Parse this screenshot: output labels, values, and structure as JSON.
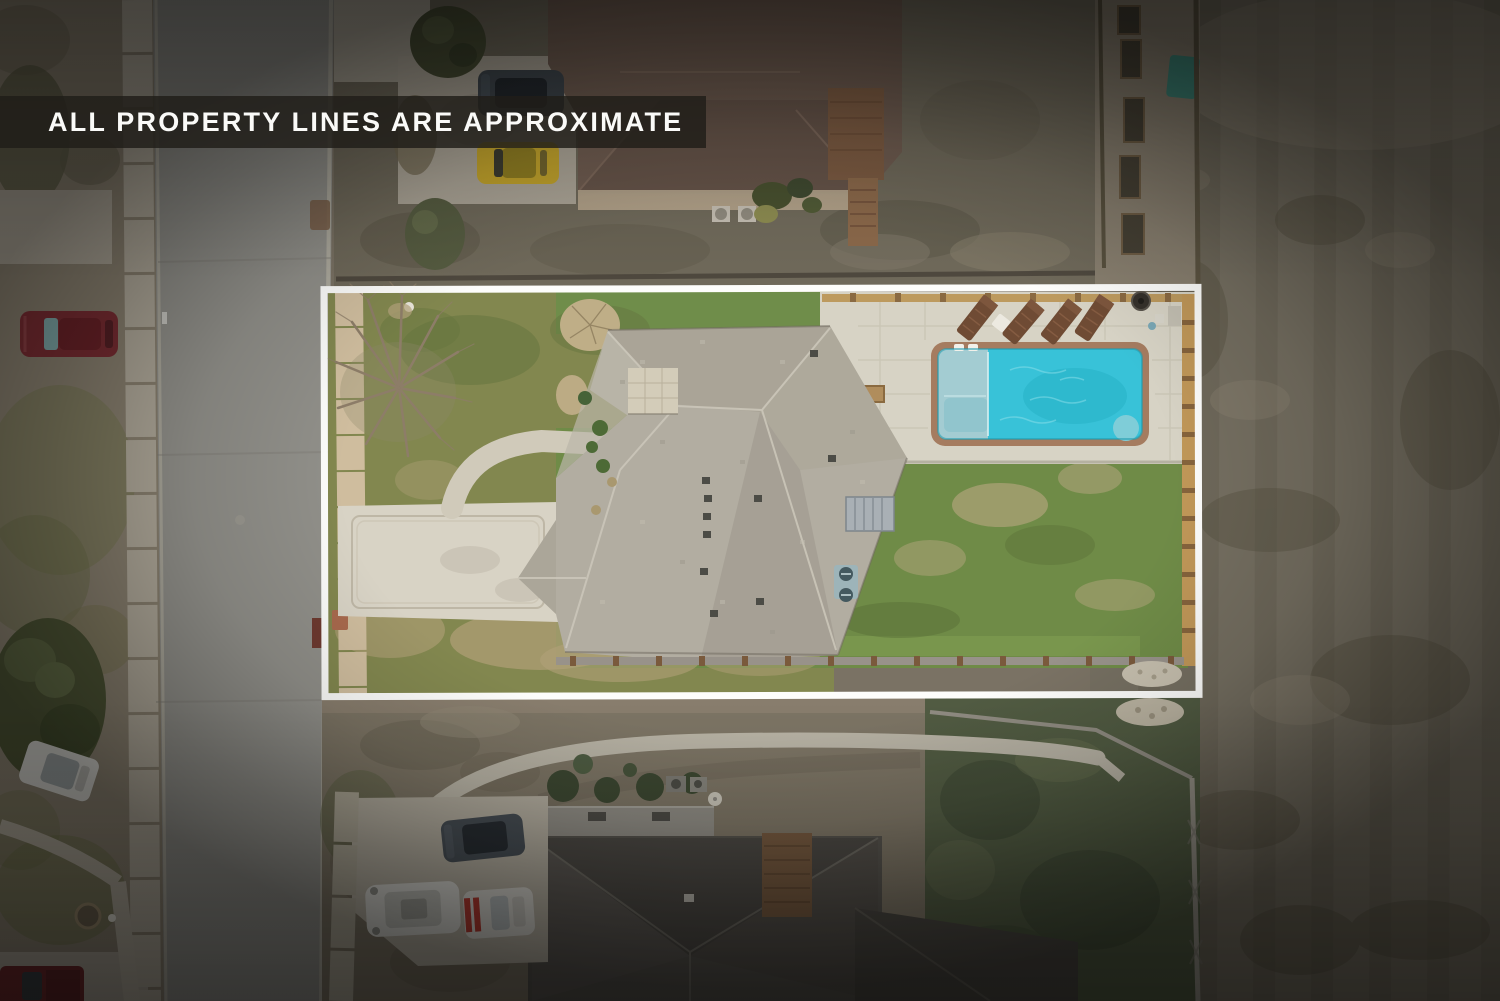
{
  "overlay": {
    "disclaimer": "ALL PROPERTY LINES ARE APPROXIMATE"
  },
  "palette": {
    "banner_bg": "rgba(32,29,25,0.82)",
    "banner_text": "#FAFAF8",
    "property_line": "#FDFDFB",
    "pool_water": "#38C2D8",
    "pool_shelf": "#A3CCD2",
    "pool_coping": "#A57C60",
    "patio_pavers": "#D7D3C5",
    "subject_roof": "#B2ADA1",
    "lawn_front": "#82874F",
    "lawn_back": "#6F8B47",
    "driveway_concrete": "#D8D3C5",
    "street_asphalt": "#91908A",
    "sidewalk": "#B0A99A",
    "field_right": "#756F61",
    "neighbor_roof_top": "#6F5C50",
    "neighbor_roof_bottom": "#56534D",
    "wood_fence_gold": "#BD9A5E",
    "car_maroon": "#7B2D33",
    "car_yellow": "#C2A32C",
    "car_white": "#D4D3CD",
    "car_dark": "#474E54",
    "racing_stripe": "#B23A30",
    "grass_neighbor": "#6F695A"
  }
}
